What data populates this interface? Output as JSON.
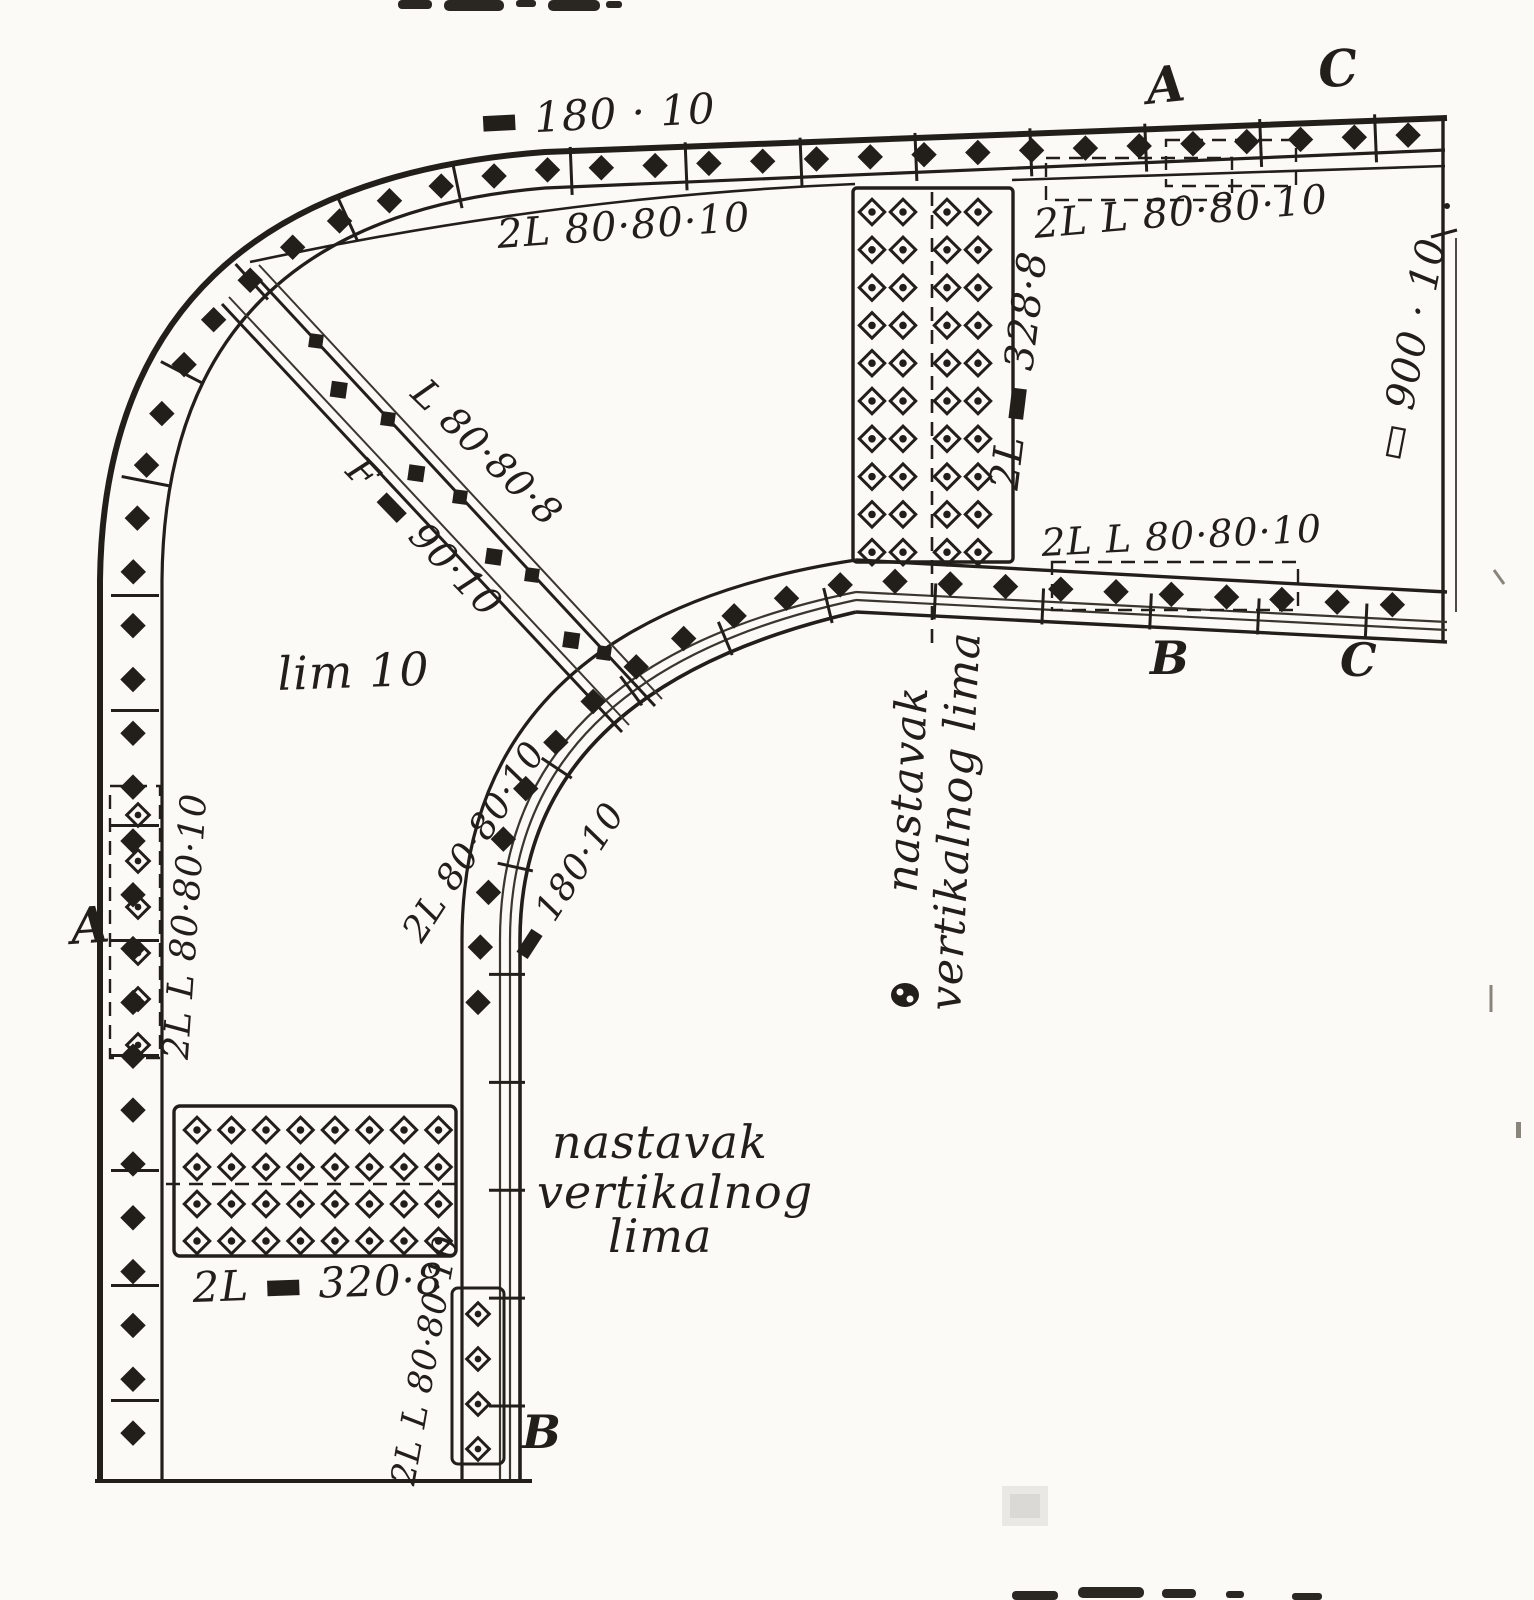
{
  "figure": {
    "kind": "scanned engineering drawing",
    "subject": "riveted steel frame-corner (knee) joint with curved flanges, splice plates and rivet fields",
    "ink_color": "#221f1b",
    "paper_color": "#fbfaf7"
  },
  "labels": {
    "top_flange_plate": "▬ 180 · 10",
    "top_chord_angles": "2L 80·80·10",
    "top_right_angles": "2L L 80·80·10",
    "vertical_splice_plates": "2L ▬ 328·8",
    "right_web_plate": "▭ 900 · 10",
    "mid_chord_angles": "2L L 80·80·10",
    "diagonal_angle": "L 80·80·8",
    "diagonal_flat_bar": "F ▬ 90·10",
    "web_plate": "lim 10",
    "inner_curve_angles": "2L 80·80·10",
    "inner_curve_plate": "▬ 180·10",
    "left_member_angles": "2L L 80·80·10",
    "bottom_splice_plates": "2L ▬ 320·8",
    "bottom_plate_angles": "2L L 80·80·10"
  },
  "notes": {
    "vertical_splice_rotated": {
      "line1": "nastavak",
      "line2": "vertikalnog lima"
    },
    "vertical_splice_bottom": {
      "line1": "nastavak",
      "line2": "vertikalnog",
      "line3": "lima"
    }
  },
  "section_letters": {
    "top_a": "A",
    "top_c": "C",
    "left_a": "A",
    "mid_b": "B",
    "mid_c": "C",
    "bottom_b": "B"
  }
}
